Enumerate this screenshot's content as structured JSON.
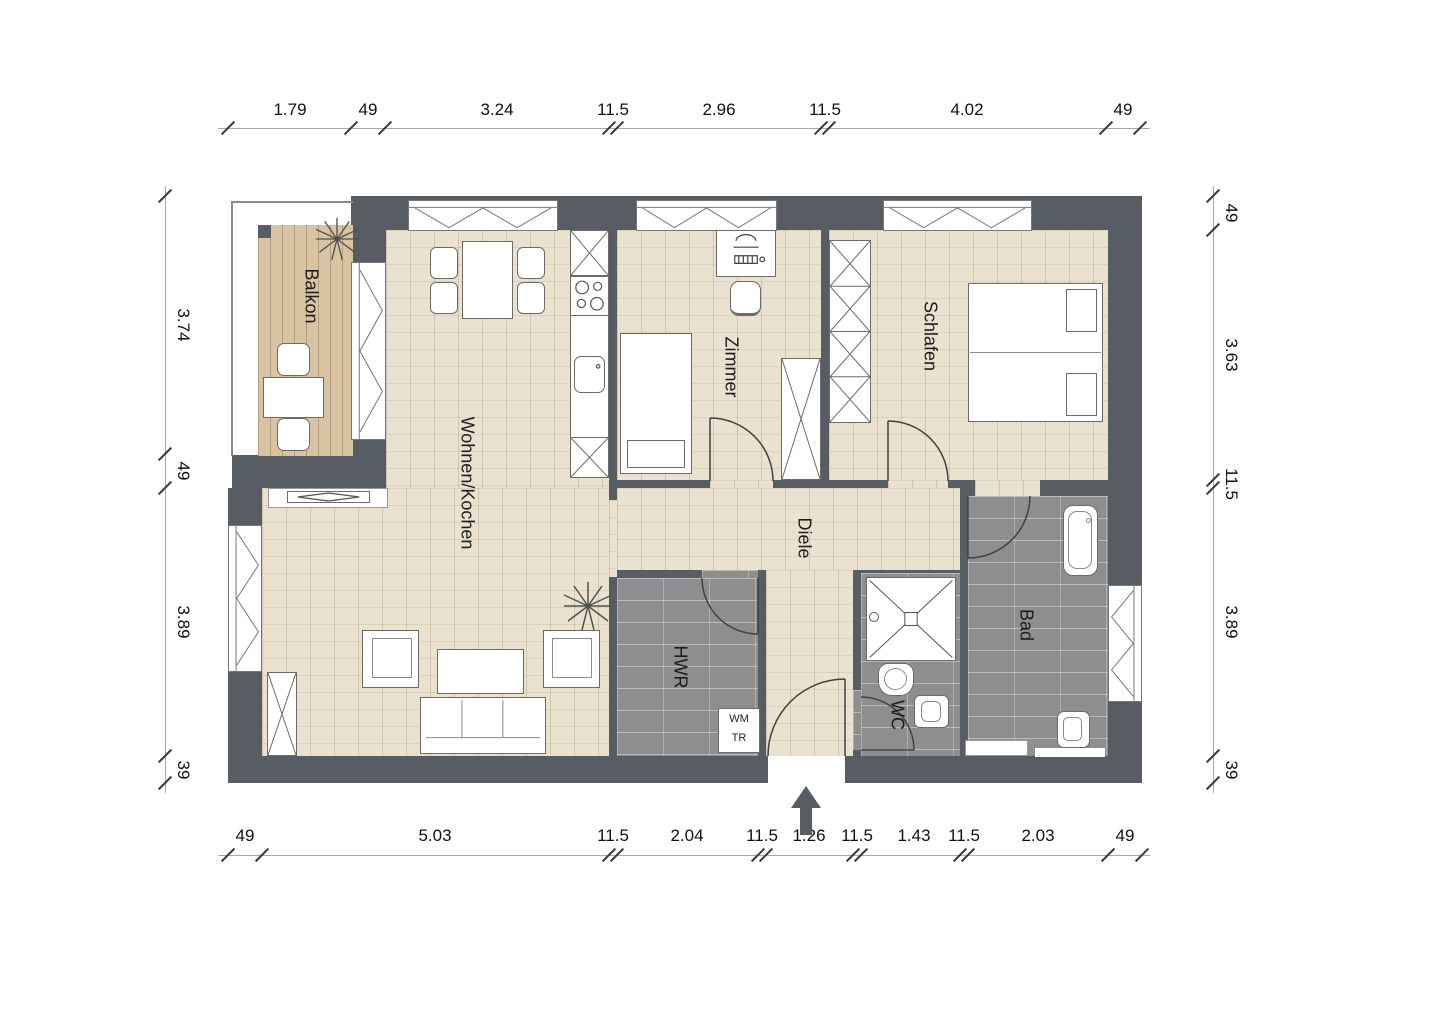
{
  "rooms": {
    "balkon": "Balkon",
    "wohnen_kochen": "Wohnen/Kochen",
    "zimmer": "Zimmer",
    "schlafen": "Schlafen",
    "diele": "Diele",
    "hwr": "HWR",
    "wc": "WC",
    "bad": "Bad"
  },
  "appliances": {
    "washing_machine": "WM",
    "dryer": "TR"
  },
  "dims": {
    "top": [
      "1.79",
      "49",
      "3.24",
      "11.5",
      "2.96",
      "11.5",
      "4.02",
      "49"
    ],
    "bottom": [
      "49",
      "5.03",
      "11.5",
      "2.04",
      "11.5",
      "1.26",
      "11.5",
      "1.43",
      "11.5",
      "2.03",
      "49"
    ],
    "left": [
      "3.74",
      "49",
      "3.89",
      "39"
    ],
    "right": [
      "49",
      "3.63",
      "11.5",
      "3.89",
      "39"
    ]
  },
  "colors": {
    "wall": "#575d63",
    "wood_floor": "#eae1cf",
    "balcony_deck": "#d8c4a3",
    "wet_room_tile": "#8e8e8f",
    "line": "#3a3a3a"
  }
}
